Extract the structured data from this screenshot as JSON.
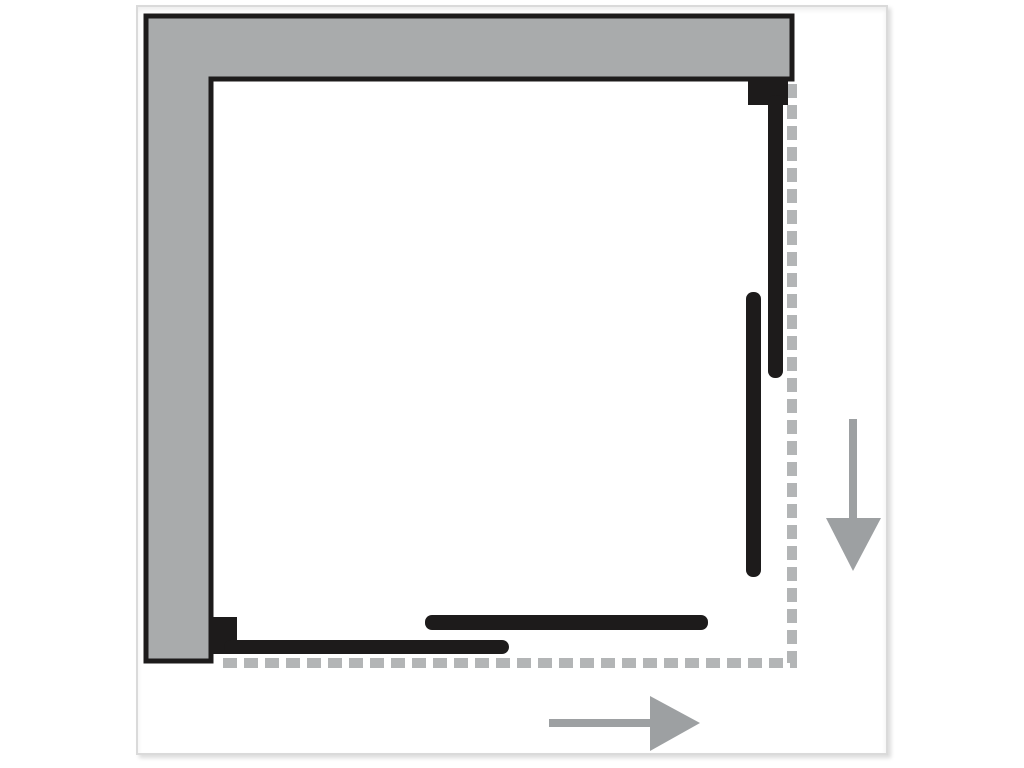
{
  "diagram": {
    "kind": "technical-plan-view",
    "subject": "corner-entry sliding shower enclosure",
    "colors": {
      "background": "#ffffff",
      "frame_border": "#dadada",
      "wall_fill": "#a9abac",
      "outline_black": "#1d1b1b",
      "panel_black": "#1d1b1b",
      "dashed_track": "#b3b5b6",
      "arrow_gray": "#9da0a2"
    },
    "frame": {
      "left": 136,
      "top": 5,
      "width": 748,
      "height": 746
    },
    "shapes": [
      {
        "name": "wall-l-shape",
        "tag": "polygon",
        "attrs": {
          "points": "146,16 792,16 792,79 211,79 211,661 146,661",
          "fill": "#a9abac",
          "stroke": "#1d1b1b",
          "stroke-width": "5",
          "stroke-linejoin": "miter"
        }
      },
      {
        "name": "enclosure-footprint-dashed-line",
        "tag": "path",
        "attrs": {
          "d": "M792,84 L792,663 L216,663",
          "fill": "none",
          "stroke": "#b3b5b6",
          "stroke-width": "10",
          "stroke-dasharray": "14 7"
        }
      },
      {
        "name": "right-door-wall-bracket",
        "tag": "rect",
        "attrs": {
          "x": "748",
          "y": "78",
          "width": "40",
          "height": "27",
          "fill": "#1d1b1b"
        }
      },
      {
        "name": "right-door-fixed-panel",
        "tag": "rect",
        "attrs": {
          "x": "768",
          "y": "95",
          "width": "15",
          "height": "283",
          "rx": "7",
          "fill": "#1d1b1b"
        }
      },
      {
        "name": "right-door-sliding-panel",
        "tag": "rect",
        "attrs": {
          "x": "746",
          "y": "292",
          "width": "15",
          "height": "285",
          "rx": "7",
          "fill": "#1d1b1b"
        }
      },
      {
        "name": "bottom-door-wall-bracket",
        "tag": "rect",
        "attrs": {
          "x": "211",
          "y": "617",
          "width": "26",
          "height": "37",
          "fill": "#1d1b1b"
        }
      },
      {
        "name": "bottom-door-fixed-panel",
        "tag": "rect",
        "attrs": {
          "x": "224",
          "y": "640",
          "width": "285",
          "height": "14",
          "rx": "7",
          "fill": "#1d1b1b"
        }
      },
      {
        "name": "bottom-door-sliding-panel",
        "tag": "rect",
        "attrs": {
          "x": "425",
          "y": "615",
          "width": "283",
          "height": "15",
          "rx": "7",
          "fill": "#1d1b1b"
        }
      },
      {
        "name": "slide-direction-down-arrow-icon",
        "tag": "g",
        "attrs": {},
        "children": [
          {
            "name": "down-arrow-shaft",
            "tag": "line",
            "attrs": {
              "x1": "853",
              "y1": "419",
              "x2": "853",
              "y2": "522",
              "stroke": "#9da0a2",
              "stroke-width": "8"
            }
          },
          {
            "name": "down-arrow-head",
            "tag": "polygon",
            "attrs": {
              "points": "826,518 881,518 853,571",
              "fill": "#9da0a2"
            }
          }
        ]
      },
      {
        "name": "slide-direction-right-arrow-icon",
        "tag": "g",
        "attrs": {},
        "children": [
          {
            "name": "right-arrow-shaft",
            "tag": "line",
            "attrs": {
              "x1": "549",
              "y1": "723",
              "x2": "655",
              "y2": "723",
              "stroke": "#9da0a2",
              "stroke-width": "8"
            }
          },
          {
            "name": "right-arrow-head",
            "tag": "polygon",
            "attrs": {
              "points": "650,696 650,751 700,723",
              "fill": "#9da0a2"
            }
          }
        ]
      }
    ]
  }
}
